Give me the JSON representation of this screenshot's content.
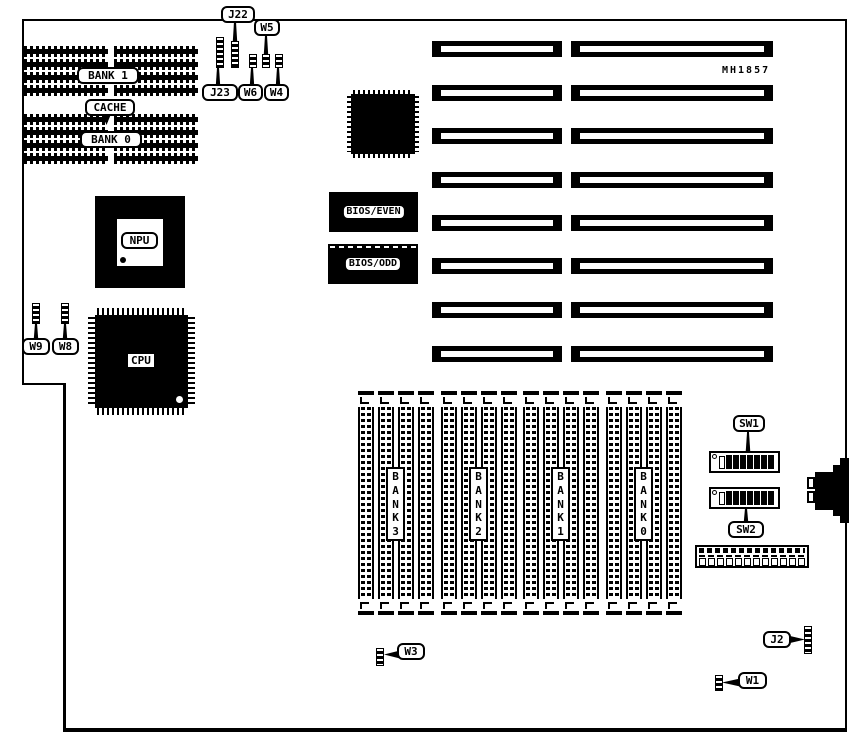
{
  "board": {
    "part_number": "MH1857",
    "cache_memory": {
      "bank1_label": "BANK 1",
      "cache_label": "CACHE",
      "bank0_label": "BANK 0"
    },
    "chips": {
      "npu_label": "NPU",
      "cpu_label": "CPU",
      "bios_even_label": "BIOS/EVEN",
      "bios_odd_label": "BIOS/ODD"
    },
    "jumpers": {
      "j22": "J22",
      "j23": "J23",
      "w4": "W4",
      "w5": "W5",
      "w6": "W6",
      "w8": "W8",
      "w9": "W9",
      "w3": "W3",
      "j2": "J2",
      "w1": "W1"
    },
    "switches": {
      "sw1_label": "SW1",
      "sw2_label": "SW2",
      "sw1_positions": [
        "open",
        "closed",
        "closed",
        "closed",
        "closed",
        "closed",
        "closed",
        "closed"
      ],
      "sw2_positions": [
        "open",
        "closed",
        "closed",
        "closed",
        "closed",
        "closed",
        "closed",
        "closed"
      ]
    },
    "simm_banks": [
      {
        "id": "bank3",
        "letters": [
          "B",
          "A",
          "N",
          "K",
          "3"
        ]
      },
      {
        "id": "bank2",
        "letters": [
          "B",
          "A",
          "N",
          "K",
          "2"
        ]
      },
      {
        "id": "bank1",
        "letters": [
          "B",
          "A",
          "N",
          "K",
          "1"
        ]
      },
      {
        "id": "bank0",
        "letters": [
          "B",
          "A",
          "N",
          "K",
          "0"
        ]
      }
    ],
    "expansion_slots": {
      "rows": 8,
      "slots_per_row": 2
    },
    "colors": {
      "ink": "#000000",
      "background": "#ffffff"
    }
  }
}
